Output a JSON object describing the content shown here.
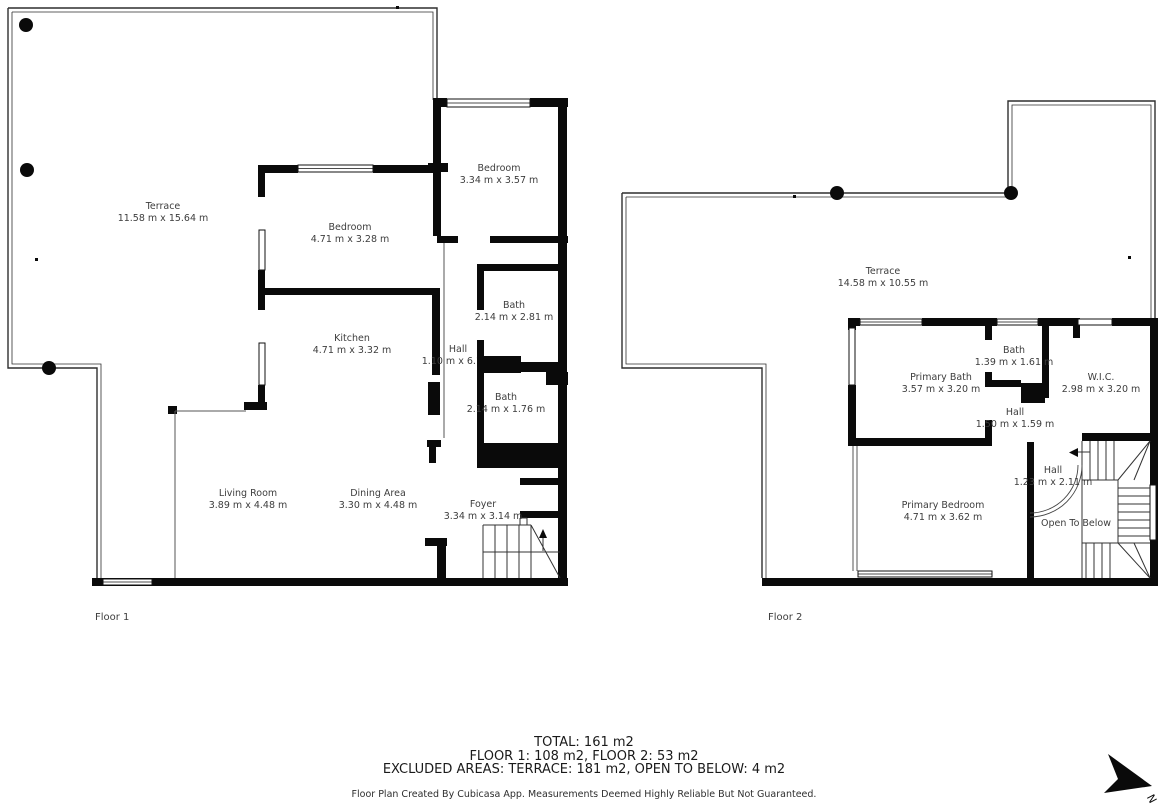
{
  "colors": {
    "background": "#ffffff",
    "wall": "#0a0a0a",
    "thin_line": "#2f2f2f",
    "label_text": "#3d3d3d",
    "summary_text": "#1a1a1a"
  },
  "floor1": {
    "label": "Floor 1",
    "rooms": [
      {
        "name": "Terrace",
        "dims": "11.58 m x 15.64 m"
      },
      {
        "name": "Bedroom",
        "dims": "4.71 m x 3.28 m"
      },
      {
        "name": "Bedroom",
        "dims": "3.34 m x 3.57 m"
      },
      {
        "name": "Kitchen",
        "dims": "4.71 m x 3.32 m"
      },
      {
        "name": "Hall",
        "dims": "1.10 m x 6.1 m"
      },
      {
        "name": "Bath",
        "dims": "2.14 m x 2.81 m"
      },
      {
        "name": "Bath",
        "dims": "2.14 m x 1.76 m"
      },
      {
        "name": "Living Room",
        "dims": "3.89 m x 4.48 m"
      },
      {
        "name": "Dining Area",
        "dims": "3.30 m x 4.48 m"
      },
      {
        "name": "Foyer",
        "dims": "3.34 m x 3.14 m"
      }
    ]
  },
  "floor2": {
    "label": "Floor 2",
    "rooms": [
      {
        "name": "Terrace",
        "dims": "14.58 m x 10.55 m"
      },
      {
        "name": "Primary Bath",
        "dims": "3.57 m x 3.20 m"
      },
      {
        "name": "Bath",
        "dims": "1.39 m x 1.61 m"
      },
      {
        "name": "W.I.C.",
        "dims": "2.98 m x 3.20 m"
      },
      {
        "name": "Hall",
        "dims": "1.50 m x 1.59 m"
      },
      {
        "name": "Hall",
        "dims": "1.23 m x 2.11 m"
      },
      {
        "name": "Primary Bedroom",
        "dims": "4.71 m x 3.62 m"
      },
      {
        "name": "Open To Below",
        "dims": ""
      }
    ]
  },
  "summary": {
    "line1": "TOTAL: 161 m2",
    "line2": "FLOOR 1: 108 m2, FLOOR 2: 53 m2",
    "line3": "EXCLUDED AREAS: TERRACE: 181 m2, OPEN TO BELOW: 4 m2",
    "disclaimer": "Floor Plan Created By Cubicasa App. Measurements Deemed Highly Reliable But Not Guaranteed."
  },
  "compass": {
    "label": "N"
  }
}
